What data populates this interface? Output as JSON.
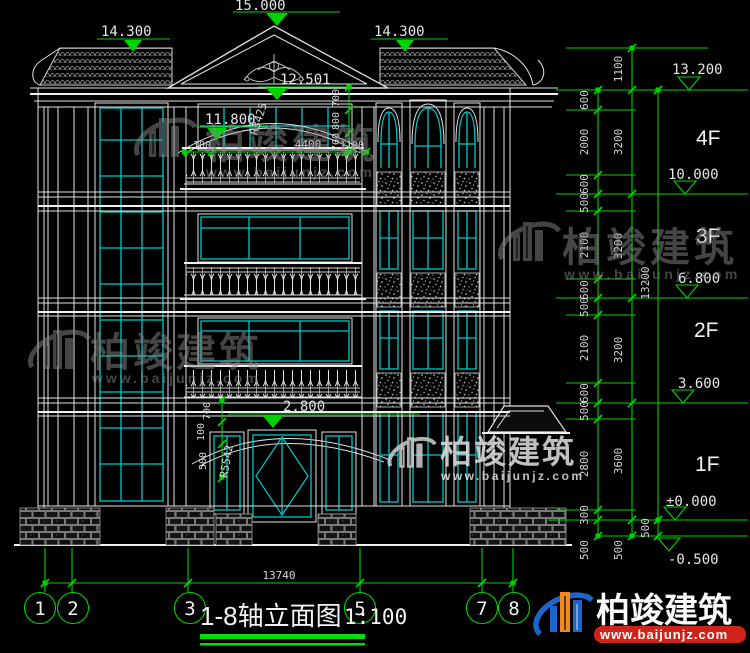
{
  "drawing": {
    "title": "1-8轴立面图",
    "scale": "1:100"
  },
  "top_levels": {
    "peak": "15.000",
    "left_eave": "14.300",
    "right_eave": "14.300"
  },
  "facade": {
    "arc_top_level": "12.501",
    "arc_spring_level": "11.800",
    "arc_radius": "R3425",
    "balcony_width": "4400",
    "balcony_end_left": "100",
    "balcony_end_right": "1100",
    "arc_chain": [
      "700",
      "800",
      "700"
    ],
    "entry_level": "2.800",
    "entry_chain": [
      "700",
      "100",
      "500"
    ],
    "entry_radius": "R5542"
  },
  "right_dimensions": {
    "detail_chain": [
      "600",
      "2000",
      "600",
      "500",
      "2100",
      "600",
      "500",
      "2100",
      "600",
      "500",
      "2800",
      "300",
      "500"
    ],
    "floor_chain": [
      "1100",
      "3200",
      "3200",
      "3200",
      "3600",
      "500"
    ],
    "total_chain": [
      "13200",
      "500"
    ],
    "levels": [
      "13.200",
      "10.000",
      "6.800",
      "3.600",
      "±0.000",
      "-0.500"
    ],
    "floors": [
      "4F",
      "3F",
      "2F",
      "1F"
    ]
  },
  "bottom": {
    "overall_width": "13740",
    "axis_labels": [
      "1",
      "2",
      "3",
      "5",
      "7",
      "8"
    ]
  },
  "watermark": {
    "brand": "柏竣建筑",
    "site": "www.baijunjz.com"
  },
  "colors": {
    "background": "#000000",
    "linework": "#e2e2e2",
    "glazing": "#00c9c9",
    "dimension": "#00d200",
    "logo_blue": "#1a66cc",
    "logo_orange": "#f0891e",
    "logo_red": "#cf2218"
  }
}
